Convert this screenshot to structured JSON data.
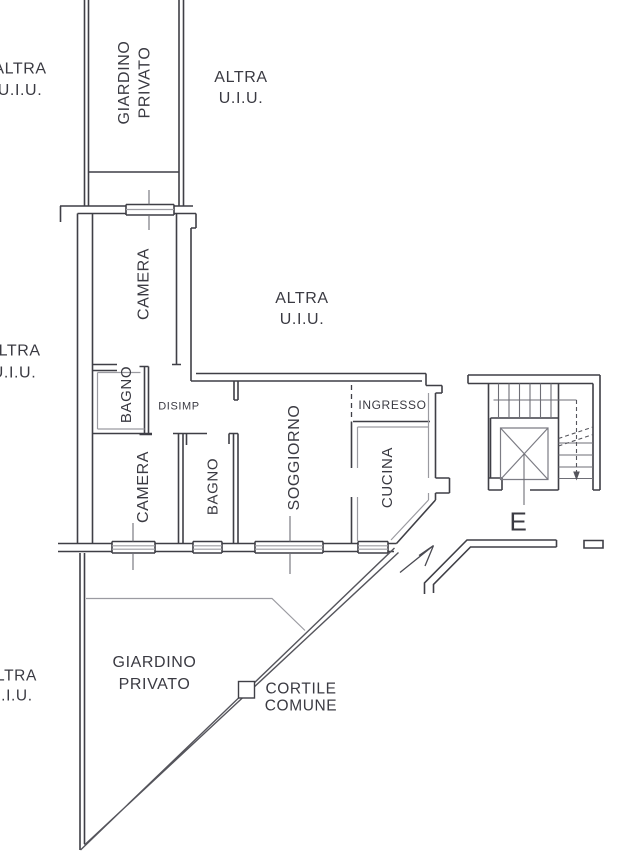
{
  "colors": {
    "line_dark": "#3f3f46",
    "line_gray": "#9b9ba1",
    "line_mid": "#6e6e76",
    "line_soft": "#7c7c84",
    "fence": "#55555c",
    "text": "#3a3a42",
    "background": "#ffffff"
  },
  "labels": [
    {
      "id": "altra-uiu-top-left",
      "size": 16,
      "rotate": 0,
      "lines": [
        {
          "text": "ALTRA",
          "x": 20,
          "y": 69
        },
        {
          "text": "U.I.U.",
          "x": 20,
          "y": 90.5
        }
      ]
    },
    {
      "id": "giardino-privato-top",
      "size": 16,
      "rotate": -90,
      "lines": [
        {
          "text": "GIARDINO",
          "x": 124.5,
          "y": 82.5
        },
        {
          "text": "PRIVATO",
          "x": 145,
          "y": 82.5
        }
      ]
    },
    {
      "id": "altra-uiu-top-right",
      "size": 16,
      "rotate": 0,
      "lines": [
        {
          "text": "ALTRA",
          "x": 241,
          "y": 77.5
        },
        {
          "text": "U.I.U.",
          "x": 241,
          "y": 98.5
        }
      ]
    },
    {
      "id": "camera-top",
      "size": 16,
      "rotate": -90,
      "lines": [
        {
          "text": "CAMERA",
          "x": 144,
          "y": 284
        }
      ]
    },
    {
      "id": "altra-uiu-center",
      "size": 16,
      "rotate": 0,
      "lines": [
        {
          "text": "ALTRA",
          "x": 302,
          "y": 298.5
        },
        {
          "text": "U.I.U.",
          "x": 302,
          "y": 319.5
        }
      ]
    },
    {
      "id": "altra-uiu-mid-left",
      "size": 16,
      "rotate": 0,
      "lines": [
        {
          "text": "ALTRA",
          "x": 14,
          "y": 351
        },
        {
          "text": "U.I.U.",
          "x": 14,
          "y": 373
        }
      ]
    },
    {
      "id": "bagno-top",
      "size": 15,
      "rotate": -90,
      "lines": [
        {
          "text": "BAGNO",
          "x": 126.5,
          "y": 394.5
        }
      ]
    },
    {
      "id": "disimp",
      "size": 11,
      "rotate": 0,
      "lines": [
        {
          "text": "DISIMP",
          "x": 179,
          "y": 406.5
        }
      ]
    },
    {
      "id": "ingresso",
      "size": 12,
      "rotate": 0,
      "lines": [
        {
          "text": "INGRESSO",
          "x": 392.5,
          "y": 405
        }
      ]
    },
    {
      "id": "camera-bottom",
      "size": 16,
      "rotate": -90,
      "lines": [
        {
          "text": "CAMERA",
          "x": 143.5,
          "y": 487
        }
      ]
    },
    {
      "id": "bagno-bottom",
      "size": 15,
      "rotate": -90,
      "lines": [
        {
          "text": "BAGNO",
          "x": 213,
          "y": 486.5
        }
      ]
    },
    {
      "id": "soggiorno",
      "size": 16,
      "rotate": -90,
      "lines": [
        {
          "text": "SOGGIORNO",
          "x": 294.5,
          "y": 457.5
        }
      ]
    },
    {
      "id": "cucina",
      "size": 15,
      "rotate": -90,
      "lines": [
        {
          "text": "CUCINA",
          "x": 387.5,
          "y": 477.5
        }
      ]
    },
    {
      "id": "stairs-e",
      "size": 26,
      "rotate": 0,
      "lines": [
        {
          "text": "E",
          "x": 518.5,
          "y": 521.5
        }
      ]
    },
    {
      "id": "giardino-privato-bottom",
      "size": 16,
      "rotate": 0,
      "lines": [
        {
          "text": "GIARDINO",
          "x": 154.5,
          "y": 662.5
        },
        {
          "text": "PRIVATO",
          "x": 154.5,
          "y": 684.5
        }
      ]
    },
    {
      "id": "cortile-comune",
      "size": 15.5,
      "rotate": 0,
      "lines": [
        {
          "text": "CORTILE",
          "x": 301,
          "y": 689
        },
        {
          "text": "COMUNE",
          "x": 301,
          "y": 706
        }
      ]
    },
    {
      "id": "altra-uiu-bottom-left",
      "size": 15.5,
      "rotate": 0,
      "lines": [
        {
          "text": "ALTRA",
          "x": 11,
          "y": 676
        },
        {
          "text": "U.I.U.",
          "x": 11,
          "y": 696
        }
      ]
    }
  ]
}
